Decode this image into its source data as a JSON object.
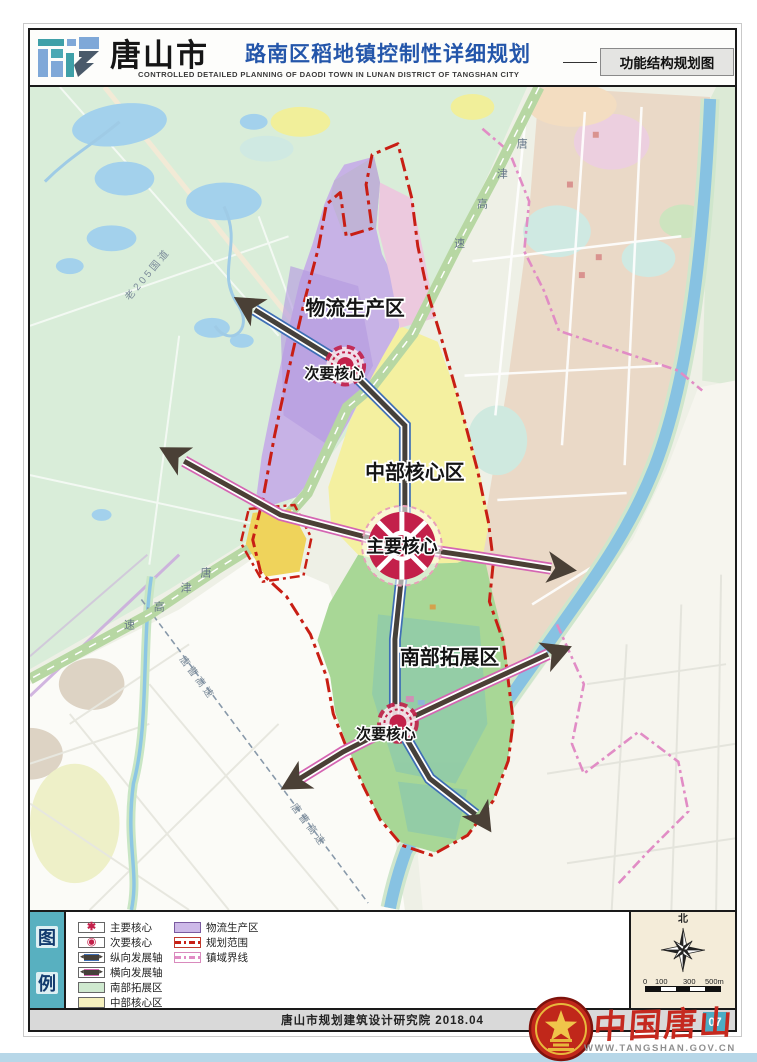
{
  "header": {
    "city": "唐山市",
    "title": "路南区稻地镇控制性详细规划",
    "subtitle": "CONTROLLED DETAILED PLANNING OF DAODI TOWN IN LUNAN DISTRICT OF TANGSHAN CITY",
    "map_type_label": "功能结构规划图"
  },
  "map": {
    "zones": {
      "logistics": "物流生产区",
      "central": "中部核心区",
      "south": "南部拓展区"
    },
    "cores": {
      "main": "主要核心",
      "secondary_north": "次要核心",
      "secondary_south": "次要核心"
    },
    "roads": {
      "old_g205": "老205国道",
      "tangjin_expressway": "唐津高速",
      "tangjin_chars": [
        "唐",
        "津",
        "高",
        "速"
      ],
      "tangcao": "唐曹高速"
    }
  },
  "legend": {
    "title": "图例",
    "title_chars": [
      "图",
      "例"
    ],
    "left_items": [
      {
        "label": "主要核心",
        "symbol": "main-core-rosette"
      },
      {
        "label": "次要核心",
        "symbol": "secondary-core-dot"
      },
      {
        "label": "纵向发展轴",
        "symbol": "vertical-development-axis"
      },
      {
        "label": "横向发展轴",
        "symbol": "horizontal-development-axis"
      },
      {
        "label": "南部拓展区",
        "symbol": "south-expansion-zone",
        "color": "#cfe9cf"
      },
      {
        "label": "中部核心区",
        "symbol": "central-core-zone",
        "color": "#f5f0bd"
      }
    ],
    "right_items": [
      {
        "label": "物流生产区",
        "symbol": "logistics-production-zone",
        "color": "#cdb9e8"
      },
      {
        "label": "规划范围",
        "symbol": "planning-boundary",
        "color": "#c81e14"
      },
      {
        "label": "镇域界线",
        "symbol": "town-boundary",
        "color": "#e18cc5"
      }
    ]
  },
  "compass": {
    "north": "北",
    "scale_labels": [
      "0",
      "100",
      "300",
      "500m"
    ]
  },
  "footer": {
    "credit": "唐山市规划建筑设计研究院 2018.04",
    "page_number": "07",
    "brand": "中国唐山",
    "website": "WWW.TANGSHAN.GOV.CN"
  },
  "colors": {
    "boundary_red": "#c81e14",
    "town_boundary_pink": "#e18cc5",
    "zone_logistics": "#c7b2e6",
    "zone_central": "#f4f0a0",
    "zone_south": "#a8d796",
    "core_red": "#c3204a",
    "axis_dark": "#45403a",
    "axis_blue": "#3f6fb5",
    "axis_pink": "#d465b2",
    "river_blue": "#87c2e2",
    "highway_green": "#b7d7a3",
    "legend_teal": "#58b0c0",
    "badge_teal": "#4cacc4"
  }
}
